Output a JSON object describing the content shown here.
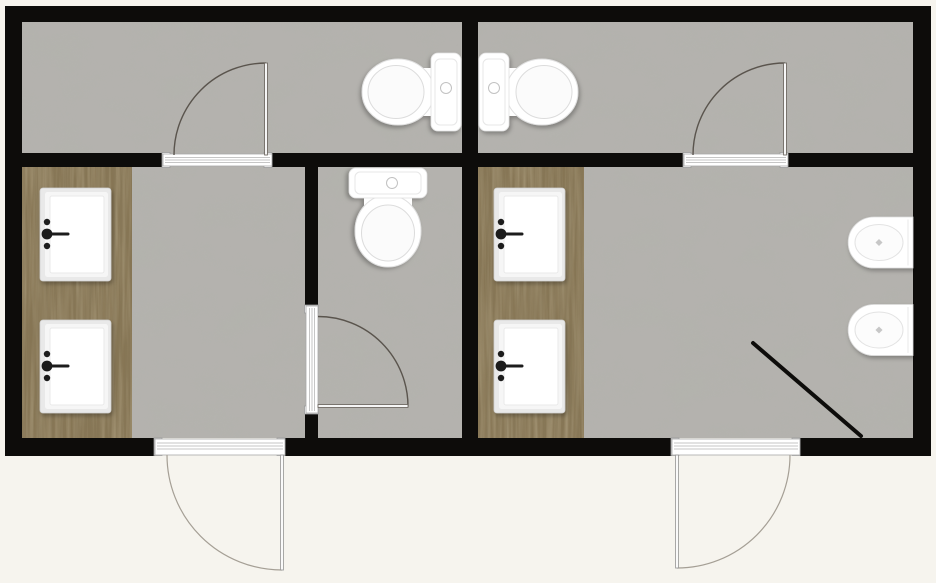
{
  "title": "Restroom floor plan — two washrooms with toilets, central WC, twin vanity counters with double sinks, two wall-hung bidets and a corner shower partition",
  "colors": {
    "background": "#f6f4ee",
    "wall": "#0d0c0a",
    "floor": "#b4b2ae",
    "floor_mottle": "#9da099",
    "wood": "#867554",
    "wood_dark": "#4f4531",
    "wood_light": "#a4936f",
    "fixture": "#ffffff",
    "fixture_edge": "#dedede",
    "faucet": "#1c1c1c",
    "door_arc": "#5a544d",
    "partition": "#0d0c0a"
  },
  "layout": {
    "type": "floor-plan",
    "areas": [
      {
        "name": "top-left-washroom",
        "floor": "concrete",
        "fixtures": [
          "toilet"
        ]
      },
      {
        "name": "top-right-washroom",
        "floor": "concrete",
        "fixtures": [
          "toilet"
        ]
      },
      {
        "name": "left-vanity-area",
        "floor": "concrete",
        "fixtures": [
          "wood-vanity-counter",
          "sink",
          "sink"
        ]
      },
      {
        "name": "central-wc",
        "floor": "concrete",
        "fixtures": [
          "toilet"
        ]
      },
      {
        "name": "right-vanity-area",
        "floor": "concrete",
        "fixtures": [
          "wood-vanity-counter",
          "sink",
          "sink",
          "bidet",
          "bidet",
          "diagonal-shower-partition"
        ]
      }
    ],
    "fixture_totals": {
      "toilets": 3,
      "sinks": 4,
      "bidets": 2,
      "vanity_counters": 2,
      "doors": 5
    },
    "doors": [
      {
        "name": "top-left-washroom-door",
        "location": "wall between top-left washroom and left vanity area",
        "swing": "opens into washroom, hinged right"
      },
      {
        "name": "top-right-washroom-door",
        "location": "wall between top-right washroom and right vanity area",
        "swing": "opens into washroom, hinged right"
      },
      {
        "name": "central-wc-door",
        "location": "wall between left vanity area and central WC",
        "swing": "opens into WC, hinged at bottom"
      },
      {
        "name": "left-entry-door",
        "location": "bottom exterior wall",
        "swing": "opens outward, hinged right"
      },
      {
        "name": "right-entry-door",
        "location": "bottom exterior wall",
        "swing": "opens outward, hinged left"
      }
    ]
  }
}
